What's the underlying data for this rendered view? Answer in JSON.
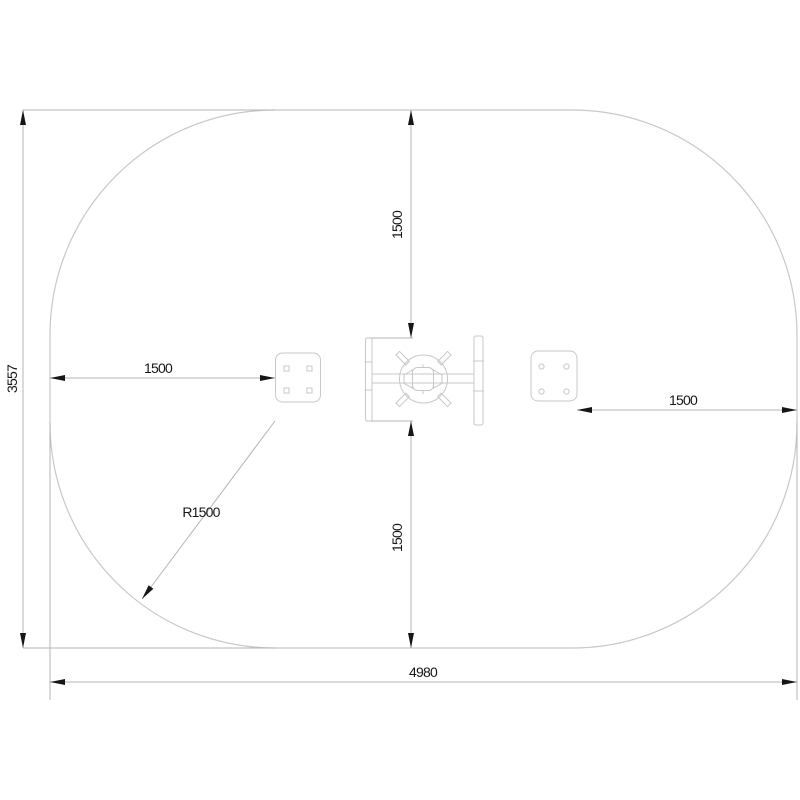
{
  "drawing": {
    "description": "Top-view technical plan of a spring seesaw inside a stadium-shaped safety area with dimensions in millimetres",
    "colors": {
      "background": "#ffffff",
      "line_color": "#c8c8c8",
      "dim_line_color": "#b5b5b5",
      "arrow_color": "#161616",
      "text_color": "#161616"
    },
    "labels": {
      "overall_width": "4980",
      "overall_height": "3557",
      "corner_radius": "R1500",
      "clearance_left": "1500",
      "clearance_right": "1500",
      "clearance_top": "1500",
      "clearance_bottom": "1500"
    }
  }
}
